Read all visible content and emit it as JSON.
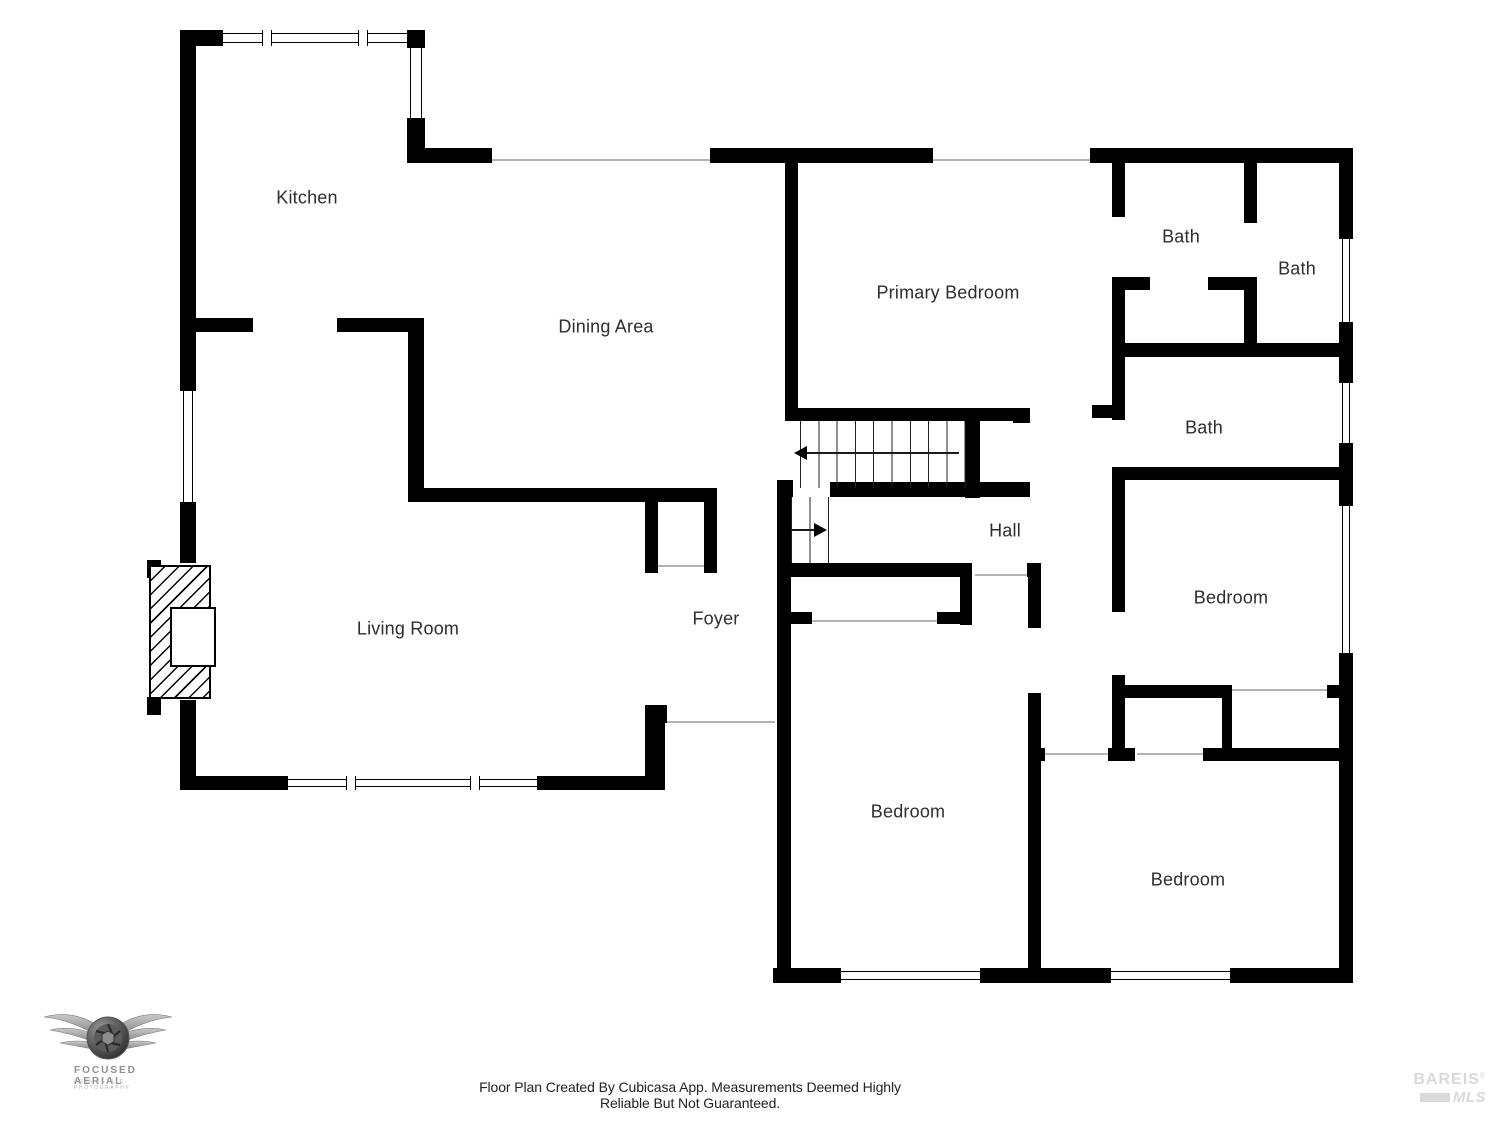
{
  "rooms": {
    "kitchen": "Kitchen",
    "dining": "Dining Area",
    "primary_bedroom": "Primary Bedroom",
    "bath_ensuite": "Bath",
    "bath_top_right": "Bath",
    "bath_middle": "Bath",
    "hall": "Hall",
    "foyer": "Foyer",
    "living": "Living Room",
    "bedroom_middle": "Bedroom",
    "bedroom_right": "Bedroom",
    "bedroom_bottom_right": "Bedroom"
  },
  "footer": {
    "disclaimer": "Floor Plan Created By Cubicasa App. Measurements Deemed Highly Reliable But Not Guaranteed."
  },
  "branding": {
    "photographer_logo": {
      "name": "FOCUSED AERIAL",
      "tagline": "REAL ESTATE PHOTOGRAPHY"
    },
    "mls_logo": {
      "name": "BAREIS",
      "reg": "®",
      "sub": "MLS"
    }
  },
  "colors": {
    "wall": "#000000",
    "label": "#2d2d2d",
    "door_line": "#b3b3b3",
    "logo_gray": "#8f8f8f",
    "mls_gray": "#d9d9d9"
  }
}
